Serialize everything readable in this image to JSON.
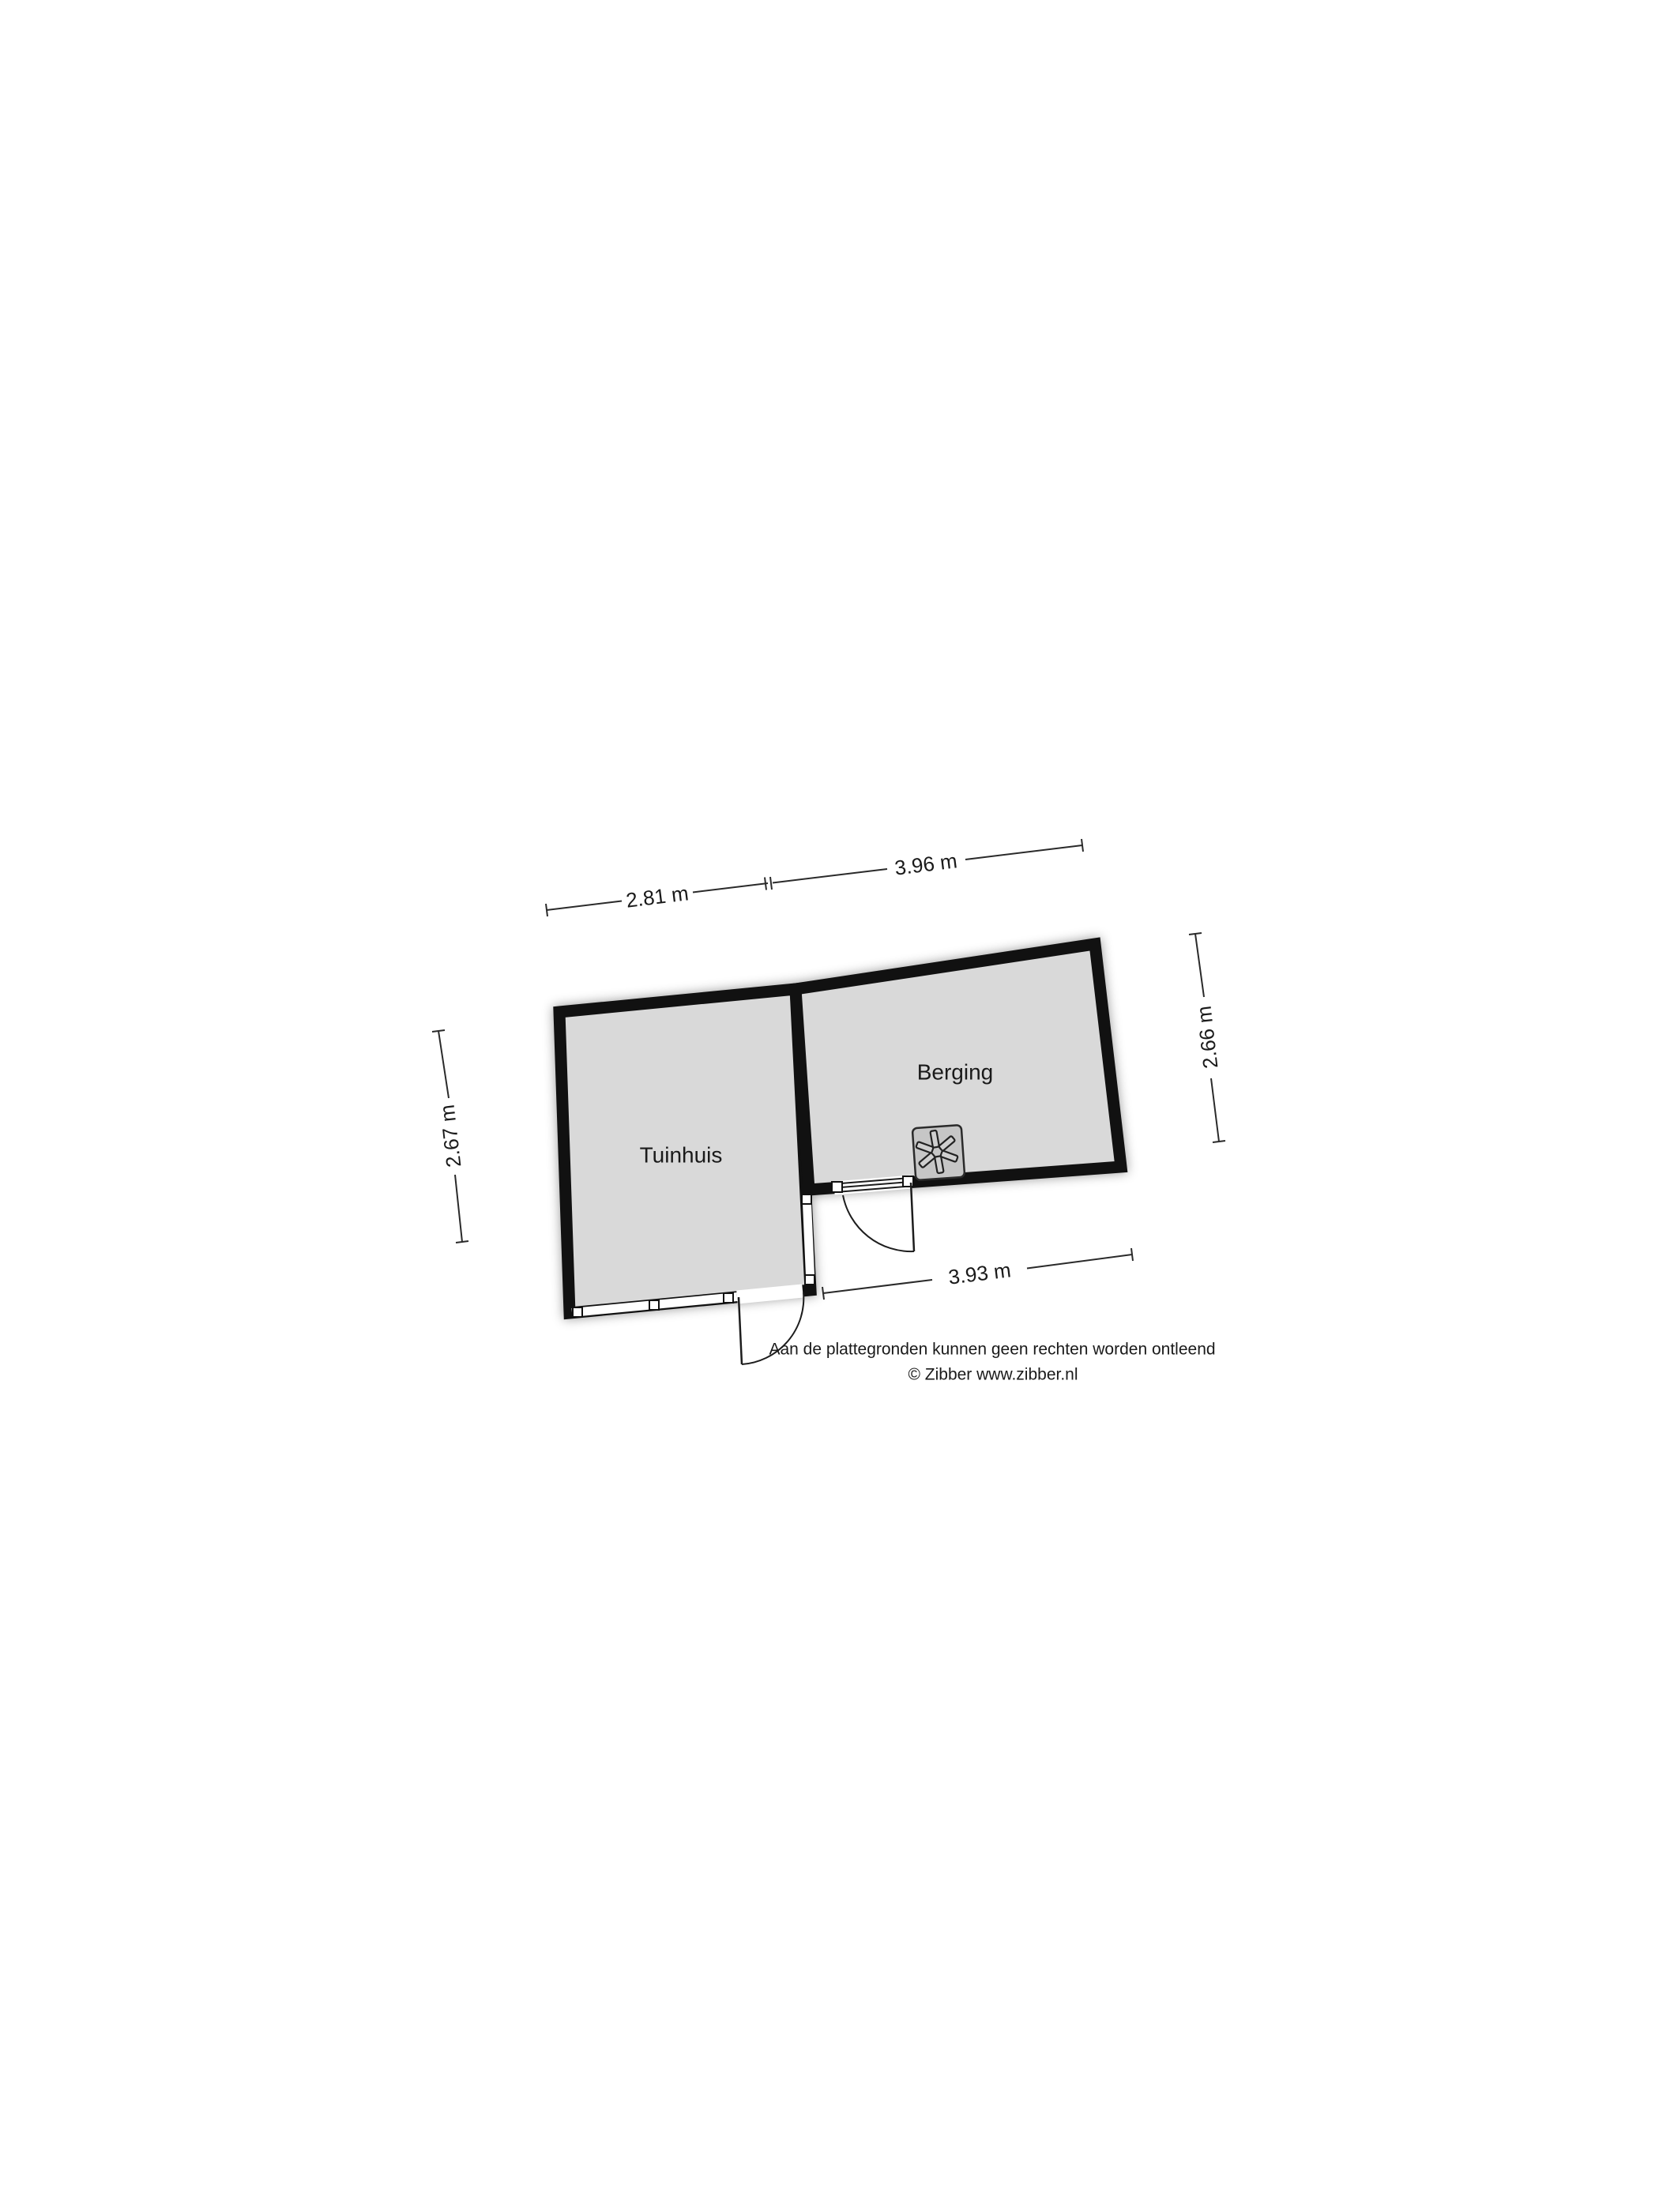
{
  "rooms": {
    "tuinhuis": {
      "label": "Tuinhuis"
    },
    "berging": {
      "label": "Berging"
    }
  },
  "dimensions": {
    "tuinhuis_width": "2.81 m",
    "berging_width": "3.96 m",
    "tuinhuis_height": "2.67 m",
    "berging_height": "2.66 m",
    "berging_bottom_width": "3.93 m"
  },
  "footer": {
    "disclaimer": "Aan de plattegronden kunnen geen rechten worden ontleend",
    "credit": "© Zibber www.zibber.nl"
  },
  "icons": {
    "stove": "stove-fan-icon",
    "doors": "door-swing-icon",
    "windows": "window-symbol"
  },
  "colors": {
    "background": "#ffffff",
    "floor": "#d9d9d9",
    "wall": "#111111",
    "stove_fill": "#c6c6c6",
    "dimension_line": "#2a2a2a",
    "text": "#1a1a1a"
  }
}
